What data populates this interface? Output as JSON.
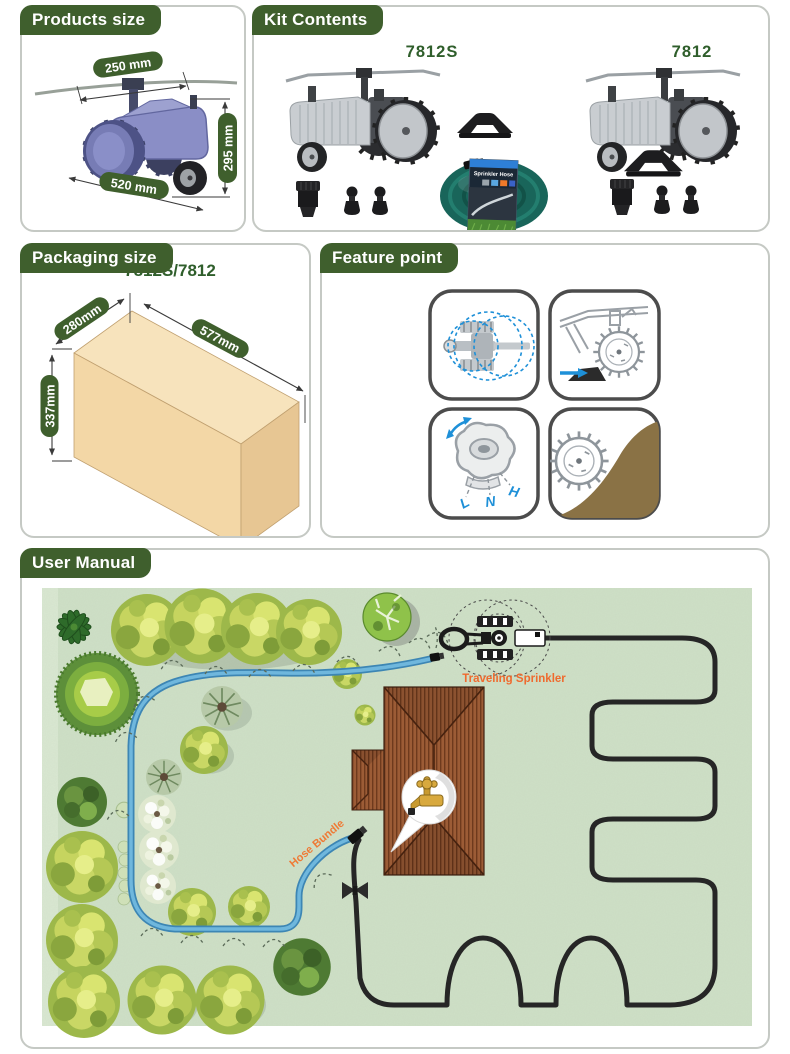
{
  "colors": {
    "header_green": "#3f5f2d",
    "model_green": "#2f5e2b",
    "accent_orange": "#ef6a2e",
    "hose_blue": "#5aa7d4",
    "hose_black": "#262626",
    "lawn_green": "#cfe0c7",
    "roof_brown": "#9c5c36",
    "box_tan": "#f3d7a6",
    "tractor_blue": "#8a8ec6"
  },
  "products_size": {
    "title": "Products size",
    "dim_width": "250 mm",
    "dim_height": "295 mm",
    "dim_length": "520 mm"
  },
  "kit_contents": {
    "title": "Kit Contents",
    "model_left": "7812S",
    "model_right": "7812",
    "hose_card_title": "Sprinkler Hose"
  },
  "packaging_size": {
    "title": "Packaging size",
    "model": "7812S/7812",
    "dim_depth": "280mm",
    "dim_length": "577mm",
    "dim_height": "337mm"
  },
  "feature_point": {
    "title": "Feature point",
    "speed_low": "L",
    "speed_neutral": "N",
    "speed_high": "H",
    "features": [
      "circular-spray-pattern",
      "auto-stop-ramp",
      "speed-control-L-N-H",
      "spiked-wheel-hill-climb"
    ]
  },
  "user_manual": {
    "title": "User Manual",
    "label_traveling_sprinkler": "Traveling Sprinkler",
    "label_hose_bundle": "Hose Bundle"
  }
}
